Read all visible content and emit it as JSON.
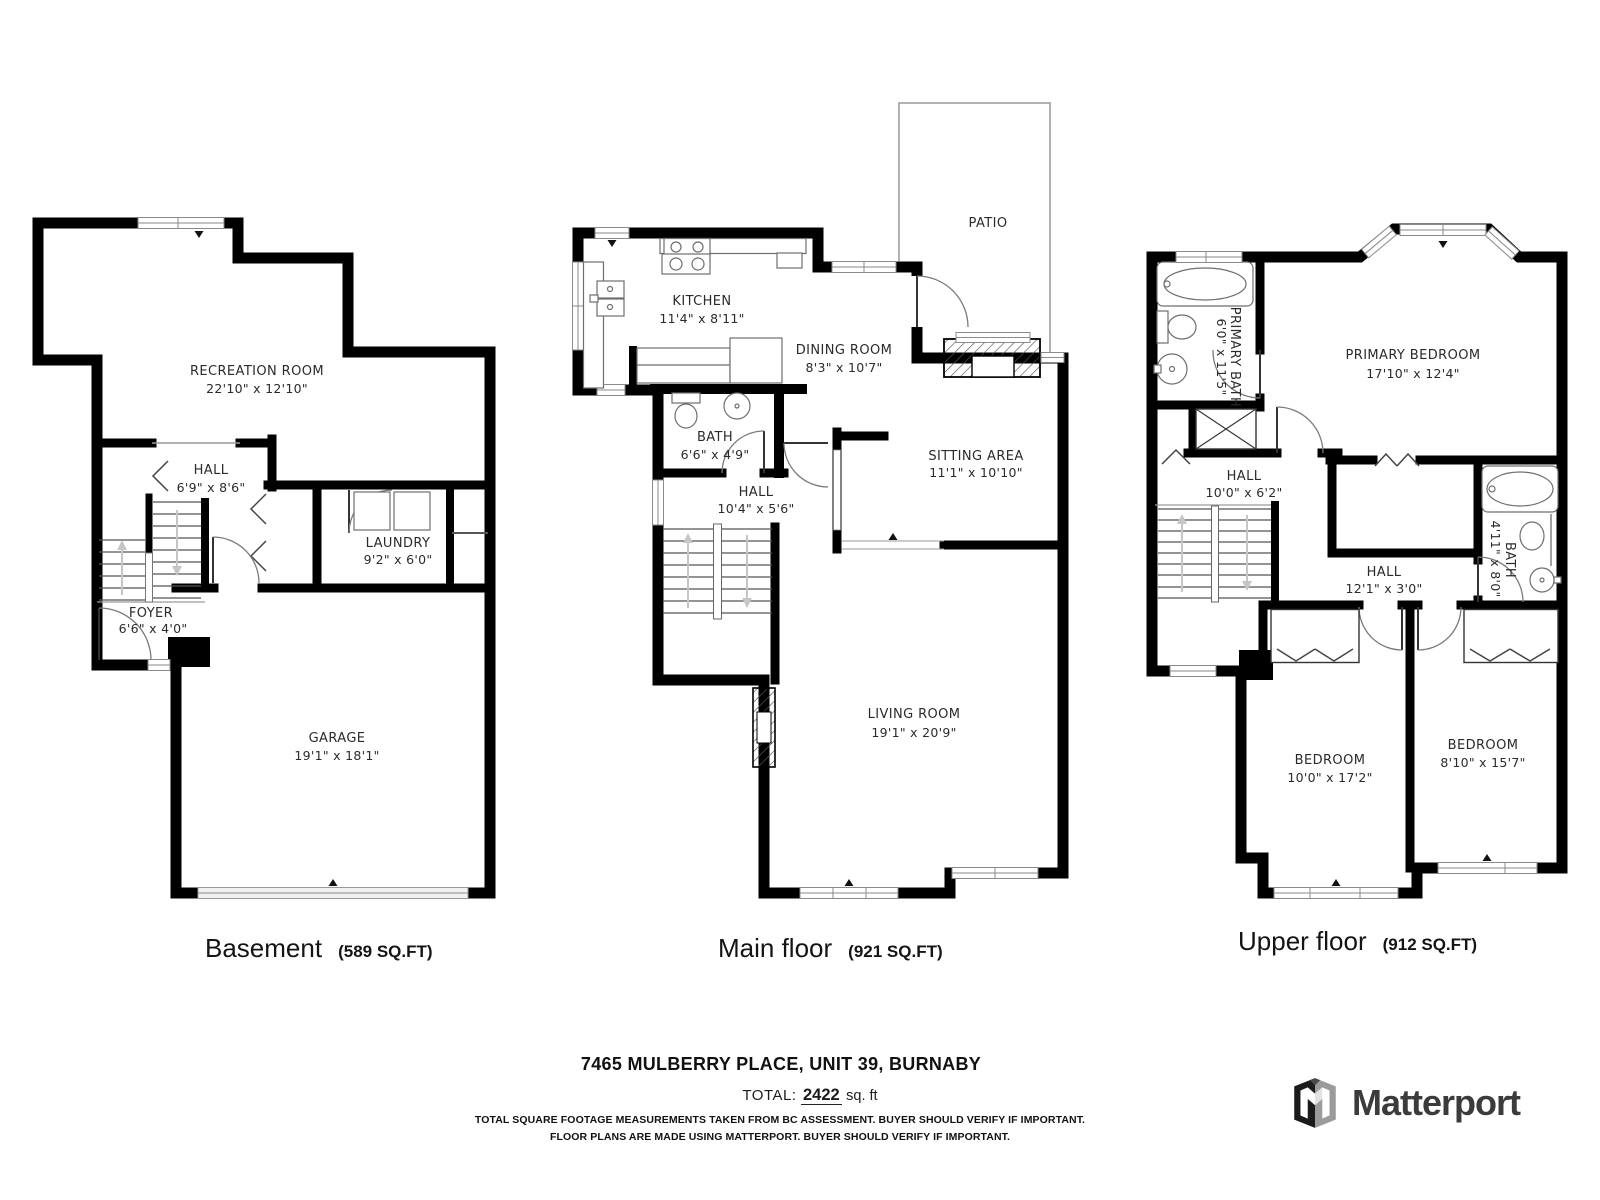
{
  "floors": [
    {
      "title": "Basement",
      "area": "(589 SQ.FT)",
      "rooms": {
        "recreation": {
          "name": "RECREATION ROOM",
          "dims": "22'10\" x 12'10\""
        },
        "hall": {
          "name": "HALL",
          "dims": "6'9\" x 8'6\""
        },
        "laundry": {
          "name": "LAUNDRY",
          "dims": "9'2\" x 6'0\""
        },
        "foyer": {
          "name": "FOYER",
          "dims": "6'6\" x 4'0\""
        },
        "garage": {
          "name": "GARAGE",
          "dims": "19'1\" x 18'1\""
        }
      }
    },
    {
      "title": "Main floor",
      "area": "(921 SQ.FT)",
      "rooms": {
        "patio": {
          "name": "PATIO",
          "dims": ""
        },
        "kitchen": {
          "name": "KITCHEN",
          "dims": "11'4\" x 8'11\""
        },
        "dining": {
          "name": "DINING ROOM",
          "dims": "8'3\" x 10'7\""
        },
        "bath": {
          "name": "BATH",
          "dims": "6'6\" x 4'9\""
        },
        "hall": {
          "name": "HALL",
          "dims": "10'4\" x 5'6\""
        },
        "sitting": {
          "name": "SITTING AREA",
          "dims": "11'1\" x 10'10\""
        },
        "living": {
          "name": "LIVING ROOM",
          "dims": "19'1\" x 20'9\""
        }
      }
    },
    {
      "title": "Upper floor",
      "area": "(912 SQ.FT)",
      "rooms": {
        "primary_bath": {
          "name": "PRIMARY BATH",
          "dims": "6'0\" x 11'5\""
        },
        "primary_bedroom": {
          "name": "PRIMARY BEDROOM",
          "dims": "17'10\" x 12'4\""
        },
        "hall_upper": {
          "name": "HALL",
          "dims": "10'0\" x 6'2\""
        },
        "hall_landing": {
          "name": "HALL",
          "dims": "12'1\" x 3'0\""
        },
        "bath": {
          "name": "BATH",
          "dims": "4'11\" x 8'0\""
        },
        "bedroom_left": {
          "name": "BEDROOM",
          "dims": "10'0\" x 17'2\""
        },
        "bedroom_right": {
          "name": "BEDROOM",
          "dims": "8'10\" x 15'7\""
        }
      }
    }
  ],
  "footer": {
    "address": "7465 MULBERRY PLACE, UNIT 39, BURNABY",
    "total_label": "TOTAL:",
    "total_value": "2422",
    "total_unit": "sq. ft",
    "disclaimer_line1": "TOTAL SQUARE FOOTAGE MEASUREMENTS TAKEN FROM BC ASSESSMENT. BUYER SHOULD VERIFY IF IMPORTANT.",
    "disclaimer_line2": "FLOOR PLANS ARE MADE USING MATTERPORT. BUYER SHOULD VERIFY IF IMPORTANT."
  },
  "branding": {
    "logo_text": "Matterport"
  }
}
